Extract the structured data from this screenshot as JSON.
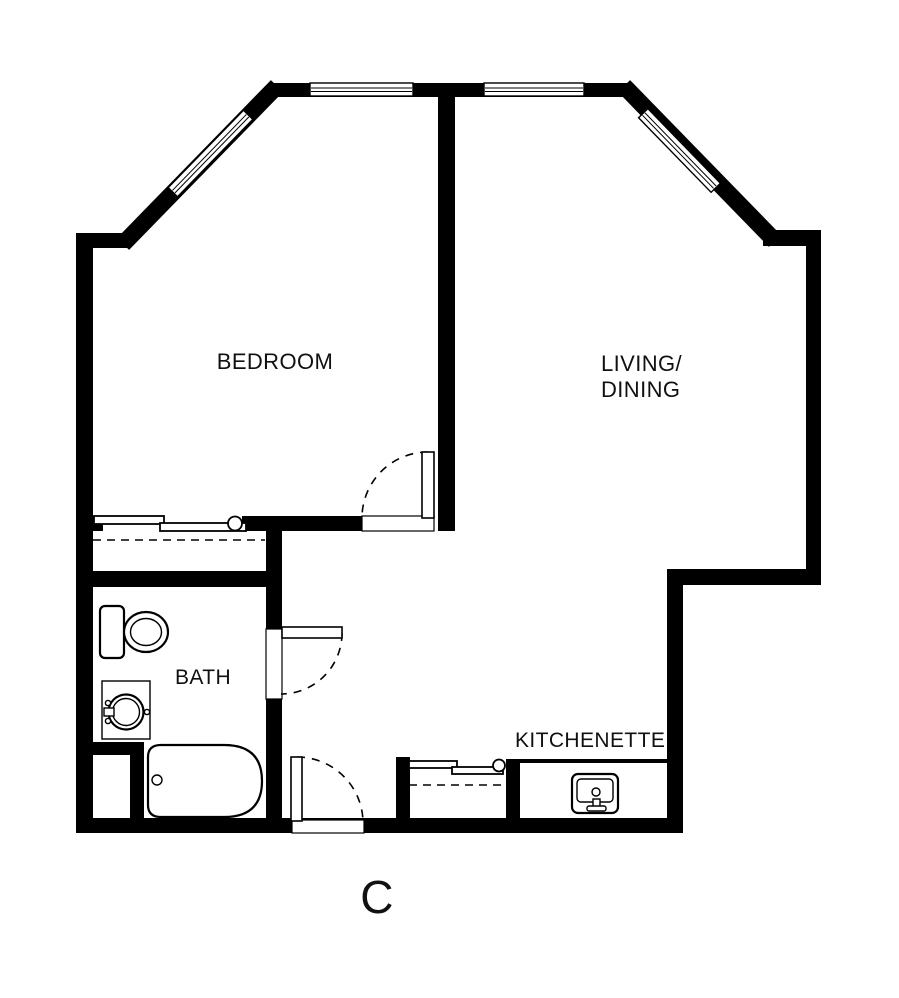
{
  "colors": {
    "background": "#ffffff",
    "walls": "#000000",
    "text": "#111111"
  },
  "labels": {
    "bedroom": "BEDROOM",
    "living_line1": "LIVING/",
    "living_line2": "DINING",
    "bath": "BATH",
    "kitchenette": "KITCHENETTE",
    "unit": "C"
  },
  "fixtures": [
    "toilet",
    "vanity-sink",
    "bathtub",
    "kitchen-sink",
    "sliding-closet-doors",
    "closet-rod-dashed",
    "swing-door-bedroom",
    "swing-door-bath",
    "swing-door-entry",
    "window"
  ]
}
